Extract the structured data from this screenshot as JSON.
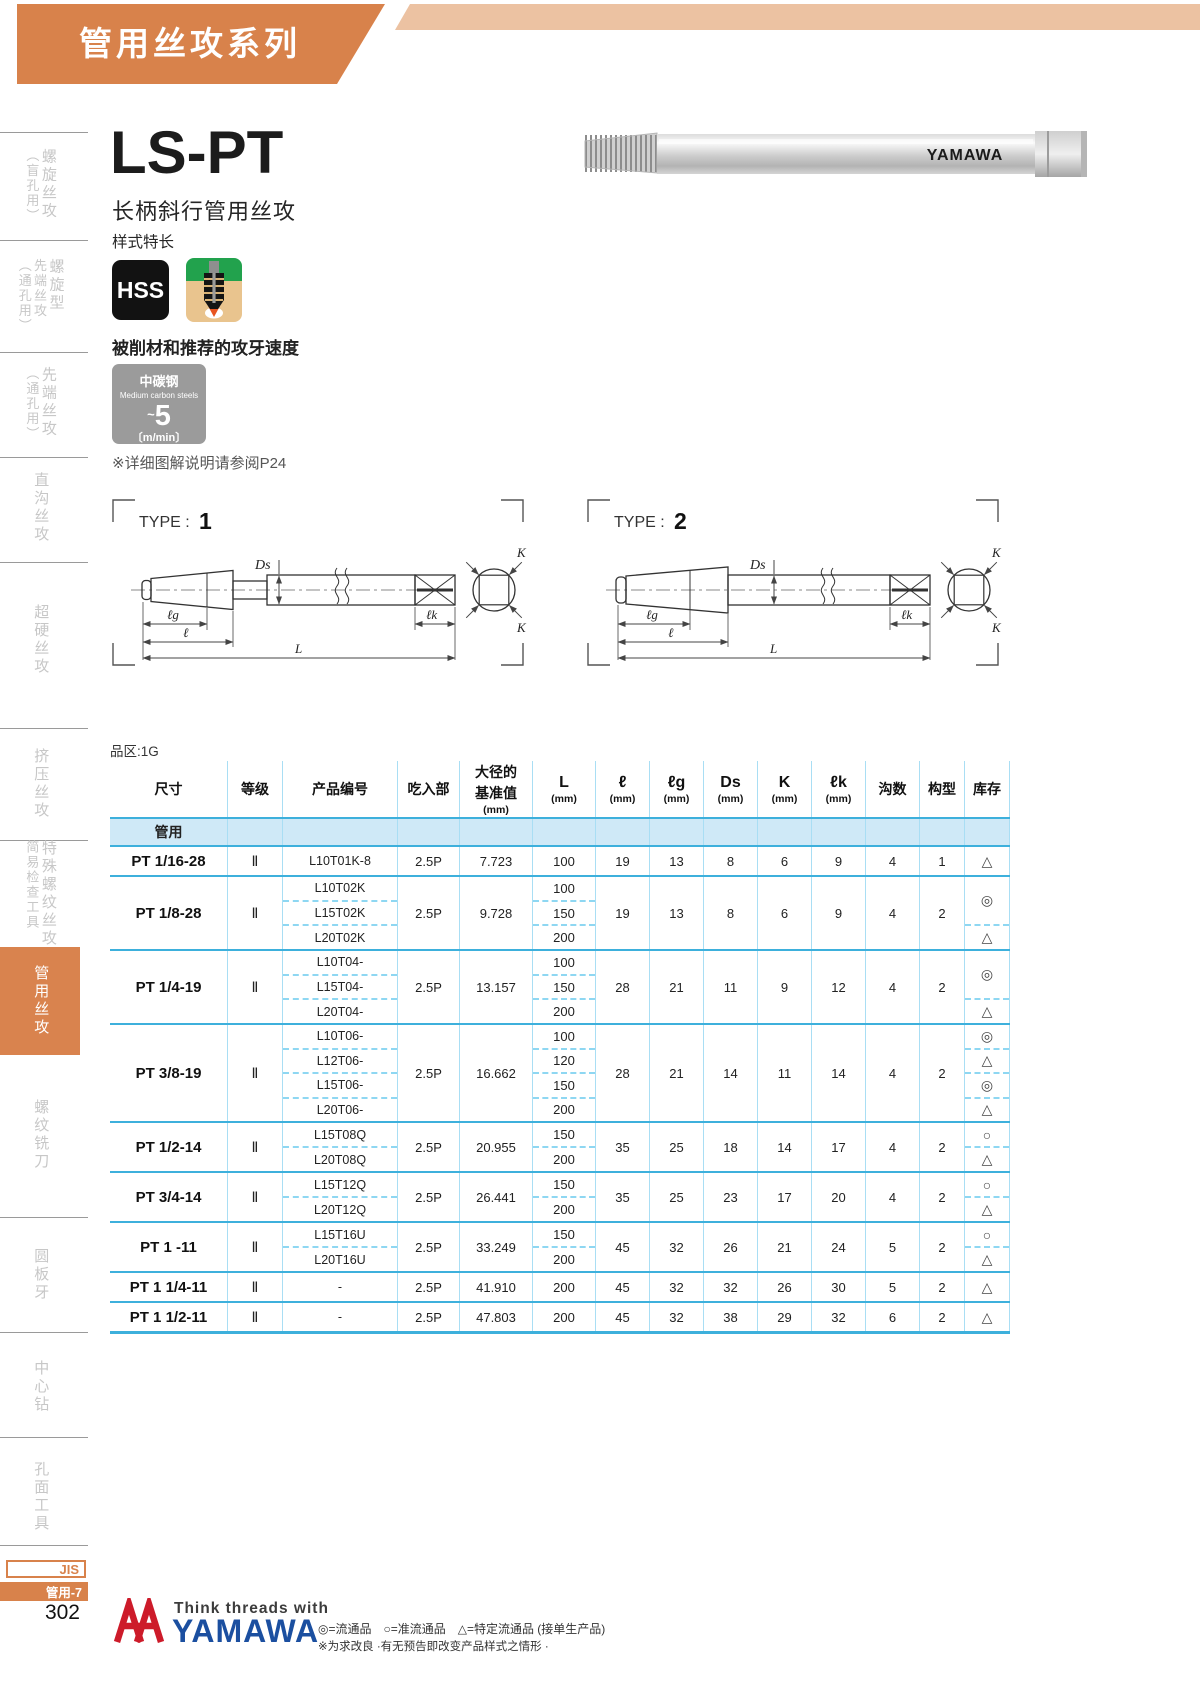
{
  "page": {
    "banner_title": "管用丝攻系列",
    "jis_label": "JIS",
    "page_tag": "管用-7",
    "page_number": "302"
  },
  "sidebar": {
    "items": [
      {
        "main": "螺旋丝攻",
        "sub": "（盲孔用）"
      },
      {
        "main": "螺旋型",
        "mid": "先端丝攻",
        "sub": "（通孔用）"
      },
      {
        "main": "先端丝攻",
        "sub": "（通孔用）"
      },
      {
        "main": "直沟丝攻"
      },
      {
        "main": "超硬丝攻"
      },
      {
        "main": "挤压丝攻"
      },
      {
        "main": "特殊螺纹丝攻",
        "sub": "简易检查工具"
      },
      {
        "main": "管用丝攻",
        "active": true
      },
      {
        "main": "螺纹铣刀"
      },
      {
        "main": "圆板牙"
      },
      {
        "main": "中心钻"
      },
      {
        "main": "孔面工具"
      }
    ]
  },
  "product": {
    "model": "LS-PT",
    "name": "长柄斜行管用丝攻",
    "style_label": "样式特长",
    "badge": "HSS",
    "photo_brand": "YAMAWA"
  },
  "speed": {
    "heading": "被削材和推荐的攻牙速度",
    "material_cn": "中碳钢",
    "material_en": "Medium carbon steels",
    "approx": "~",
    "value": "5",
    "unit": "〔m/min〕",
    "note": "※详细图解说明请参阅P24"
  },
  "diagrams": {
    "type_label": "TYPE :",
    "type1_num": "1",
    "type2_num": "2",
    "labels": {
      "ds": "Ds",
      "lg": "ℓg",
      "l": "ℓ",
      "L": "L",
      "lk": "ℓk",
      "k": "K"
    }
  },
  "table": {
    "zone_label": "品区:1G",
    "group_label": "管用",
    "headers": [
      {
        "main": "尺寸"
      },
      {
        "main": "等级"
      },
      {
        "main": "产品编号"
      },
      {
        "main": "吃入部"
      },
      {
        "main": "大径的",
        "second": "基准值",
        "unit": "(mm)"
      },
      {
        "main": "L",
        "unit": "(mm)"
      },
      {
        "main": "ℓ",
        "unit": "(mm)"
      },
      {
        "main": "ℓg",
        "unit": "(mm)"
      },
      {
        "main": "Ds",
        "unit": "(mm)"
      },
      {
        "main": "K",
        "unit": "(mm)"
      },
      {
        "main": "ℓk",
        "unit": "(mm)"
      },
      {
        "main": "沟数"
      },
      {
        "main": "构型"
      },
      {
        "main": "库存"
      }
    ],
    "rows": [
      {
        "size": "PT 1/16-28",
        "grade": "Ⅱ",
        "products": [
          "L10T01K-8"
        ],
        "chamfer": "2.5P",
        "major_dia": "7.723",
        "lengths": [
          "100"
        ],
        "l": "19",
        "lg": "13",
        "ds": "8",
        "k": "6",
        "lk": "9",
        "flutes": "4",
        "type": "1",
        "stock": [
          {
            "sym": "△",
            "span": 1
          }
        ]
      },
      {
        "size": "PT 1/8-28",
        "grade": "Ⅱ",
        "products": [
          "L10T02K",
          "L15T02K",
          "L20T02K"
        ],
        "chamfer": "2.5P",
        "major_dia": "9.728",
        "lengths": [
          "100",
          "150",
          "200"
        ],
        "l": "19",
        "lg": "13",
        "ds": "8",
        "k": "6",
        "lk": "9",
        "flutes": "4",
        "type": "2",
        "stock": [
          {
            "sym": "◎",
            "span": 2
          },
          {
            "sym": "△",
            "span": 1
          }
        ]
      },
      {
        "size": "PT 1/4-19",
        "grade": "Ⅱ",
        "products": [
          "L10T04-",
          "L15T04-",
          "L20T04-"
        ],
        "chamfer": "2.5P",
        "major_dia": "13.157",
        "lengths": [
          "100",
          "150",
          "200"
        ],
        "l": "28",
        "lg": "21",
        "ds": "11",
        "k": "9",
        "lk": "12",
        "flutes": "4",
        "type": "2",
        "stock": [
          {
            "sym": "◎",
            "span": 2
          },
          {
            "sym": "△",
            "span": 1
          }
        ]
      },
      {
        "size": "PT 3/8-19",
        "grade": "Ⅱ",
        "products": [
          "L10T06-",
          "L12T06-",
          "L15T06-",
          "L20T06-"
        ],
        "chamfer": "2.5P",
        "major_dia": "16.662",
        "lengths": [
          "100",
          "120",
          "150",
          "200"
        ],
        "l": "28",
        "lg": "21",
        "ds": "14",
        "k": "11",
        "lk": "14",
        "flutes": "4",
        "type": "2",
        "stock": [
          {
            "sym": "◎",
            "span": 1
          },
          {
            "sym": "△",
            "span": 1
          },
          {
            "sym": "◎",
            "span": 1
          },
          {
            "sym": "△",
            "span": 1
          }
        ]
      },
      {
        "size": "PT 1/2-14",
        "grade": "Ⅱ",
        "products": [
          "L15T08Q",
          "L20T08Q"
        ],
        "chamfer": "2.5P",
        "major_dia": "20.955",
        "lengths": [
          "150",
          "200"
        ],
        "l": "35",
        "lg": "25",
        "ds": "18",
        "k": "14",
        "lk": "17",
        "flutes": "4",
        "type": "2",
        "stock": [
          {
            "sym": "○",
            "span": 1
          },
          {
            "sym": "△",
            "span": 1
          }
        ]
      },
      {
        "size": "PT 3/4-14",
        "grade": "Ⅱ",
        "products": [
          "L15T12Q",
          "L20T12Q"
        ],
        "chamfer": "2.5P",
        "major_dia": "26.441",
        "lengths": [
          "150",
          "200"
        ],
        "l": "35",
        "lg": "25",
        "ds": "23",
        "k": "17",
        "lk": "20",
        "flutes": "4",
        "type": "2",
        "stock": [
          {
            "sym": "○",
            "span": 1
          },
          {
            "sym": "△",
            "span": 1
          }
        ]
      },
      {
        "size": "PT 1 -11",
        "grade": "Ⅱ",
        "products": [
          "L15T16U",
          "L20T16U"
        ],
        "chamfer": "2.5P",
        "major_dia": "33.249",
        "lengths": [
          "150",
          "200"
        ],
        "l": "45",
        "lg": "32",
        "ds": "26",
        "k": "21",
        "lk": "24",
        "flutes": "5",
        "type": "2",
        "stock": [
          {
            "sym": "○",
            "span": 1
          },
          {
            "sym": "△",
            "span": 1
          }
        ]
      },
      {
        "size": "PT 1 1/4-11",
        "grade": "Ⅱ",
        "products": [
          "-"
        ],
        "chamfer": "2.5P",
        "major_dia": "41.910",
        "lengths": [
          "200"
        ],
        "l": "45",
        "lg": "32",
        "ds": "32",
        "k": "26",
        "lk": "30",
        "flutes": "5",
        "type": "2",
        "stock": [
          {
            "sym": "△",
            "span": 1
          }
        ]
      },
      {
        "size": "PT 1 1/2-11",
        "grade": "Ⅱ",
        "products": [
          "-"
        ],
        "chamfer": "2.5P",
        "major_dia": "47.803",
        "lengths": [
          "200"
        ],
        "l": "45",
        "lg": "32",
        "ds": "38",
        "k": "29",
        "lk": "32",
        "flutes": "6",
        "type": "2",
        "stock": [
          {
            "sym": "△",
            "span": 1
          }
        ]
      }
    ]
  },
  "footer": {
    "tagline": "Think threads with",
    "brand": "YAMAWA",
    "legend": "◎=流通品　○=准流通品　△=特定流通品 (接单生产品)",
    "note": "※为求改良 ·有无预告即改变产品样式之情形 ·"
  }
}
